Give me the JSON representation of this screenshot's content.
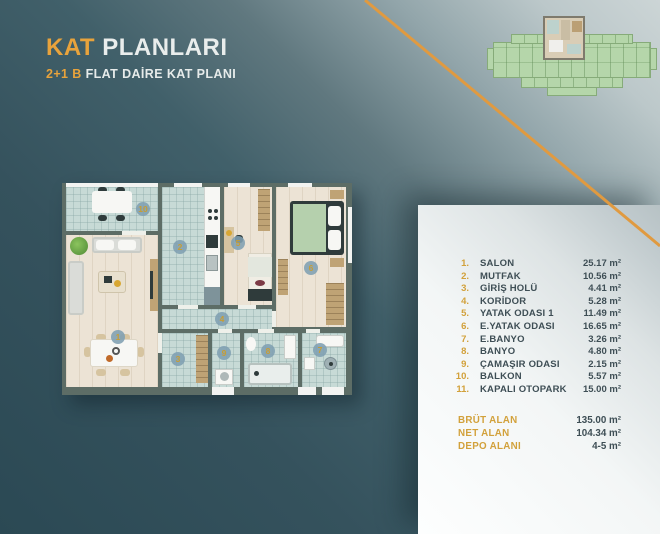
{
  "header": {
    "title_accent": "KAT",
    "title_rest": "PLANLARI",
    "subtitle_accent": "2+1 B",
    "subtitle_rest": "FLAT DAİRE KAT PLANI"
  },
  "legend": {
    "items": [
      {
        "num": "1.",
        "name": "SALON",
        "area": "25.17 m²"
      },
      {
        "num": "2.",
        "name": "MUTFAK",
        "area": "10.56 m²"
      },
      {
        "num": "3.",
        "name": "GİRİŞ HOLÜ",
        "area": "4.41 m²"
      },
      {
        "num": "4.",
        "name": "KORİDOR",
        "area": "5.28 m²"
      },
      {
        "num": "5.",
        "name": "YATAK ODASI 1",
        "area": "11.49 m²"
      },
      {
        "num": "6.",
        "name": "E.YATAK ODASI",
        "area": "16.65 m²"
      },
      {
        "num": "7.",
        "name": "E.BANYO",
        "area": "3.26 m²"
      },
      {
        "num": "8.",
        "name": "BANYO",
        "area": "4.80 m²"
      },
      {
        "num": "9.",
        "name": "ÇAMAŞIR ODASI",
        "area": "2.15 m²"
      },
      {
        "num": "10.",
        "name": "BALKON",
        "area": "5.57 m²"
      },
      {
        "num": "11.",
        "name": "KAPALI OTOPARK",
        "area": "15.00 m²"
      }
    ]
  },
  "summary": {
    "items": [
      {
        "label": "BRÜT ALAN",
        "value": "135.00 m²"
      },
      {
        "label": "NET ALAN",
        "value": "104.34 m²"
      },
      {
        "label": "DEPO ALANI",
        "value": "4-5 m²"
      }
    ]
  },
  "plan": {
    "badges": [
      "1",
      "2",
      "3",
      "4",
      "5",
      "6",
      "7",
      "8",
      "9",
      "10"
    ]
  },
  "colors": {
    "accent_orange": "#E8A33C",
    "badge_number": "#C79D35",
    "panel_text": "#3E4E55",
    "background_teal": "#2B4954",
    "tile_floor": "#C7DAD6",
    "wood_floor": "#ECE3D5",
    "wall": "#5D6D66",
    "keyplan_green": "#B5D6AA"
  }
}
